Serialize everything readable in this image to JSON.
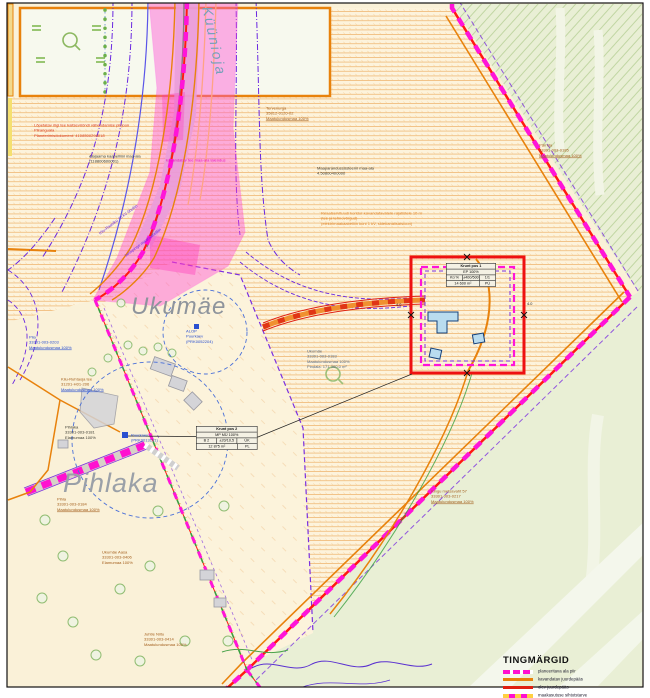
{
  "stream_label": "Küünioja",
  "places": {
    "ukumae": "Ukumäe",
    "pihlaka": "Pihlaka"
  },
  "dims": {
    "left": "4.0",
    "right": "4.0"
  },
  "tables": {
    "pos1": {
      "title": "Krunt pos 1",
      "use": "EP 100%",
      "c1": "Kü %",
      "c2": "±400/500",
      "c3": "1/1",
      "area": "14 600 m²",
      "c5": "PÜ"
    },
    "pos2": {
      "title": "Krunt pos 2",
      "use": "MP MÜ 100%",
      "c1": "B 2",
      "c2": "±20/10,5",
      "c3": "ÜK",
      "area": "12 875 m²",
      "c5": "PL"
    }
  },
  "legend": {
    "title": "TINGMÄRGID",
    "rows": [
      {
        "label": "planeeritava ala piir"
      },
      {
        "label": "kavandatav juurdepääs"
      },
      {
        "label": "olev juurdepääs"
      },
      {
        "label": "maakasutuse sihtotstarve"
      }
    ]
  },
  "annotations": {
    "road_restriction": {
      "lines": [
        "Lõpetatav riigi tee kaitsevööndi vähendamise piirjoon",
        "Piiranguala",
        "Planeerimisdokument: 4108500298018"
      ]
    },
    "alajaam": {
      "lines": [
        "Alajaama kaabelliini maa-ala",
        "(118800600001)"
      ]
    },
    "tervenurga": {
      "lines": [
        "Tervenurga",
        "35812-0120-02",
        "Maatulundusmaa 100%"
      ]
    },
    "maaparandus": {
      "lines": [
        "Maaparandussüsteemi maa-ala",
        "4.50800400000"
      ]
    },
    "servituut": {
      "lines": [
        "Reaalservituudi koridor kavandatavatele rajatistele 10 m",
        "(tee ja tehnovõrgud)",
        "(elektrimaakaabelliin kuni 1 kV, sidekanalisatsioon)"
      ]
    },
    "parnda": {
      "lines": [
        "Pärnda",
        "33301-003-0185",
        "Maatulundusmaa 100%"
      ]
    },
    "ukumae_parcel": {
      "lines": [
        "Ukumäe",
        "33301-003-0183",
        "Maatulundusmaa 100%",
        "Pindala: 171 360,0 m²"
      ]
    },
    "piia": {
      "lines": [
        "Piia",
        "33301-003-0203",
        "Maatulundusmaa 100%"
      ]
    },
    "kiiu_tee": {
      "lines": [
        "Kiiu-Ruhtaoja tee",
        "31201-H01-206",
        "Maatulundusmaa 100%"
      ]
    },
    "pihlaka_parcel": {
      "lines": [
        "Pihlaka",
        "33301-003-0181",
        "Elamumaa 100%"
      ]
    },
    "puurkaev1": {
      "lines": [
        "Puurkaev",
        "(PRK0013191)"
      ]
    },
    "puurkaev2": {
      "lines": [
        "ALOP",
        "Puurkaev",
        "(PRK0052204)"
      ]
    },
    "pihla": {
      "lines": [
        "Pihla",
        "33301-003-0184",
        "Maatulundusmaa 100%"
      ]
    },
    "ukumae_aasa": {
      "lines": [
        "Ukumäe Aasa",
        "33301-003-0406",
        "Elamumaa 100%"
      ]
    },
    "juhtle": {
      "lines": [
        "Juhtle Niitu",
        "33301-003-0414",
        "Maatulundusmaa 100%"
      ]
    },
    "kingu": {
      "lines": [
        "Kingu metsavaht 57",
        "33301-003-0217",
        "Maatulundusmaa 100%"
      ]
    },
    "tee_laiendus": {
      "lines": [
        "kavandatav tee maa-ala laiendus"
      ]
    },
    "ohuliin": {
      "lines": [
        "Kiiu-Raasiku 35 kV õhuliin"
      ]
    },
    "maakaabel": {
      "lines": [
        "keskpinge maakaabelliin"
      ]
    }
  },
  "colors": {
    "boundary_magenta": "#ff14d8",
    "boundary_red": "#ff1a10",
    "access_orange": "#e8820c",
    "protection_purple": "#6a28e0",
    "stream_blue": "#5a55e8",
    "hatch_orange": "#eeb168",
    "green_area": "#e9efd5"
  }
}
